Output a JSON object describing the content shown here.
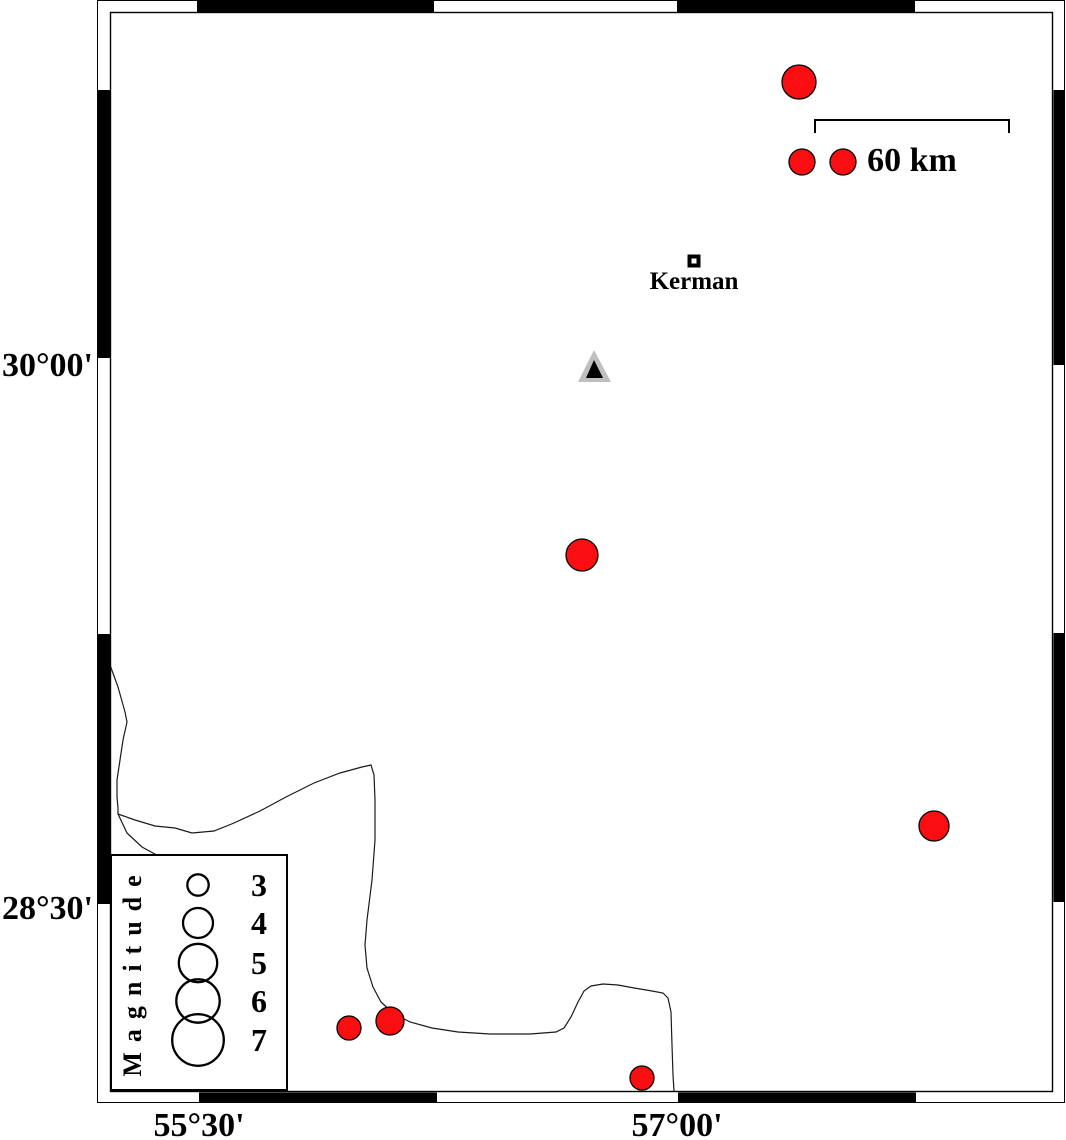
{
  "map": {
    "background": "#ffffff",
    "frame": {
      "outer": {
        "x": 97,
        "y": 0,
        "w": 968,
        "h": 1103
      },
      "inner": {
        "x": 110,
        "y": 12,
        "w": 943,
        "h": 1080
      },
      "black_color": "#000000",
      "black_segments": {
        "top": [
          [
            197,
            434
          ],
          [
            677,
            915
          ]
        ],
        "bottom": [
          [
            199,
            437
          ],
          [
            678,
            916
          ]
        ],
        "left": [
          [
            90,
            358
          ],
          [
            634,
            904
          ]
        ],
        "right": [
          [
            90,
            365
          ],
          [
            633,
            902
          ]
        ]
      }
    },
    "axis_labels": {
      "left": [
        {
          "text": "30°00'",
          "x": 93,
          "y": 376
        },
        {
          "text": "28°30'",
          "x": 93,
          "y": 919
        }
      ],
      "bottom": [
        {
          "text": "55°30'",
          "x": 199,
          "y": 1136
        },
        {
          "text": "57°00'",
          "x": 677,
          "y": 1136
        }
      ]
    },
    "scalebar": {
      "x1": 815,
      "x2": 1009,
      "y": 120,
      "tick_len": 13,
      "label": "60 km",
      "label_x": 912,
      "label_y": 171
    },
    "city": {
      "name": "Kerman",
      "x": 694,
      "y": 261,
      "size": 13,
      "hole": 5,
      "label_x": 694,
      "label_y": 289
    },
    "station": {
      "outer_points": [
        [
          594,
          350
        ],
        [
          578,
          382
        ],
        [
          611,
          382
        ]
      ],
      "inner_points": [
        [
          594,
          360
        ],
        [
          586,
          378
        ],
        [
          603,
          378
        ]
      ],
      "outer_color": "#bfbfbf",
      "inner_color": "#000000"
    },
    "earthquakes": {
      "fill": "#fa0e12",
      "stroke": "#000000",
      "points": [
        {
          "x": 799,
          "y": 82,
          "r": 17
        },
        {
          "x": 802,
          "y": 162,
          "r": 13
        },
        {
          "x": 843,
          "y": 162,
          "r": 13
        },
        {
          "x": 582,
          "y": 555,
          "r": 16
        },
        {
          "x": 934,
          "y": 826,
          "r": 15
        },
        {
          "x": 349,
          "y": 1028,
          "r": 12
        },
        {
          "x": 390,
          "y": 1021,
          "r": 14
        },
        {
          "x": 642,
          "y": 1078,
          "r": 12
        }
      ]
    },
    "boundaries": {
      "color": "#1a1a1a",
      "lines": [
        {
          "points": [
            [
              110,
              665
            ],
            [
              118,
              687
            ],
            [
              125,
              712
            ],
            [
              127,
              722
            ],
            [
              123,
              740
            ],
            [
              120,
              760
            ],
            [
              117,
              780
            ],
            [
              117,
              797
            ],
            [
              118,
              808
            ],
            [
              118,
              814
            ],
            [
              127,
              833
            ],
            [
              142,
              847
            ],
            [
              153,
              853
            ],
            [
              160,
              857
            ]
          ]
        },
        {
          "points": [
            [
              118,
              814
            ],
            [
              135,
              820
            ],
            [
              155,
              826
            ],
            [
              175,
              828
            ],
            [
              192,
              833
            ],
            [
              214,
              831
            ],
            [
              234,
              823
            ],
            [
              260,
              811
            ],
            [
              286,
              797
            ],
            [
              314,
              783
            ],
            [
              340,
              773
            ],
            [
              362,
              767
            ],
            [
              371,
              765
            ],
            [
              374,
              775
            ],
            [
              375,
              800
            ],
            [
              375,
              840
            ],
            [
              372,
              880
            ],
            [
              367,
              920
            ],
            [
              365,
              945
            ],
            [
              367,
              968
            ],
            [
              373,
              987
            ],
            [
              381,
              1002
            ],
            [
              393,
              1013
            ],
            [
              410,
              1022
            ],
            [
              432,
              1028
            ],
            [
              458,
              1032
            ],
            [
              490,
              1034
            ],
            [
              530,
              1034
            ],
            [
              556,
              1032
            ],
            [
              564,
              1028
            ],
            [
              571,
              1017
            ],
            [
              578,
              1002
            ],
            [
              584,
              991
            ],
            [
              591,
              986
            ],
            [
              603,
              984
            ],
            [
              618,
              985
            ],
            [
              634,
              988
            ],
            [
              652,
              991
            ],
            [
              663,
              993
            ],
            [
              668,
              998
            ],
            [
              671,
              1012
            ],
            [
              672,
              1045
            ],
            [
              673,
              1075
            ],
            [
              674,
              1091
            ]
          ]
        }
      ]
    },
    "legend": {
      "box": {
        "x": 110,
        "y": 854,
        "w": 176,
        "h": 235
      },
      "title": "Magnitude",
      "title_x": 141,
      "title_y": 971,
      "circle_cx": 198,
      "label_x": 259,
      "circle_stroke": "#000000",
      "entries": [
        {
          "mag": "3",
          "cy": 885,
          "r": 10.7
        },
        {
          "mag": "4",
          "cy": 923,
          "r": 15
        },
        {
          "mag": "5",
          "cy": 963,
          "r": 19.2
        },
        {
          "mag": "6",
          "cy": 1001,
          "r": 21.7
        },
        {
          "mag": "7",
          "cy": 1040,
          "r": 25.8
        }
      ]
    }
  }
}
